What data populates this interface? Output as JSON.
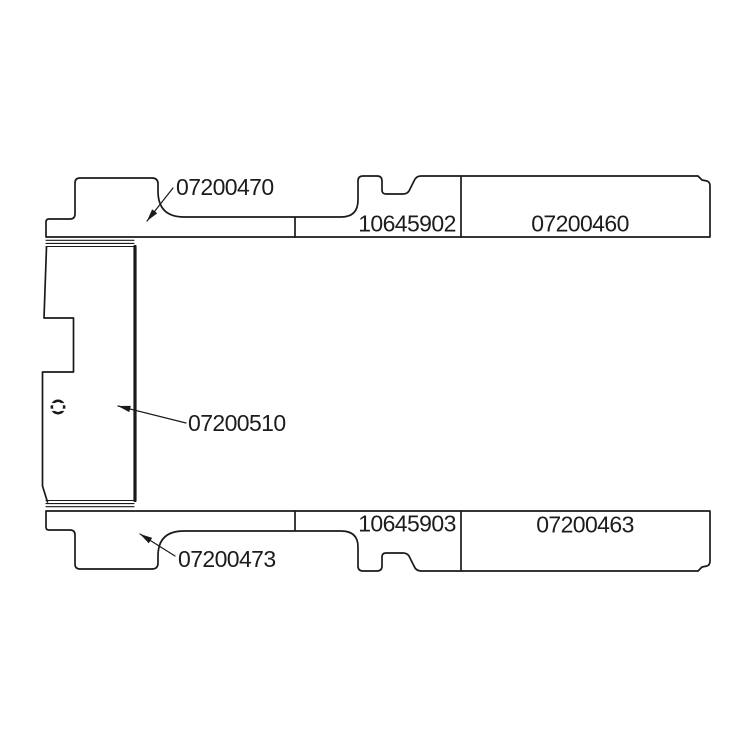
{
  "page": {
    "background": "#ffffff",
    "kind": "technical-parts-diagram"
  },
  "colors": {
    "line": "#1a1a1a",
    "text": "#1c1c1c"
  },
  "labels": {
    "top_left": "07200470",
    "top_middle": "10645902",
    "top_right": "07200460",
    "side_panel": "07200510",
    "bottom_left": "07200473",
    "bottom_middle": "10645903",
    "bottom_right": "07200463"
  }
}
